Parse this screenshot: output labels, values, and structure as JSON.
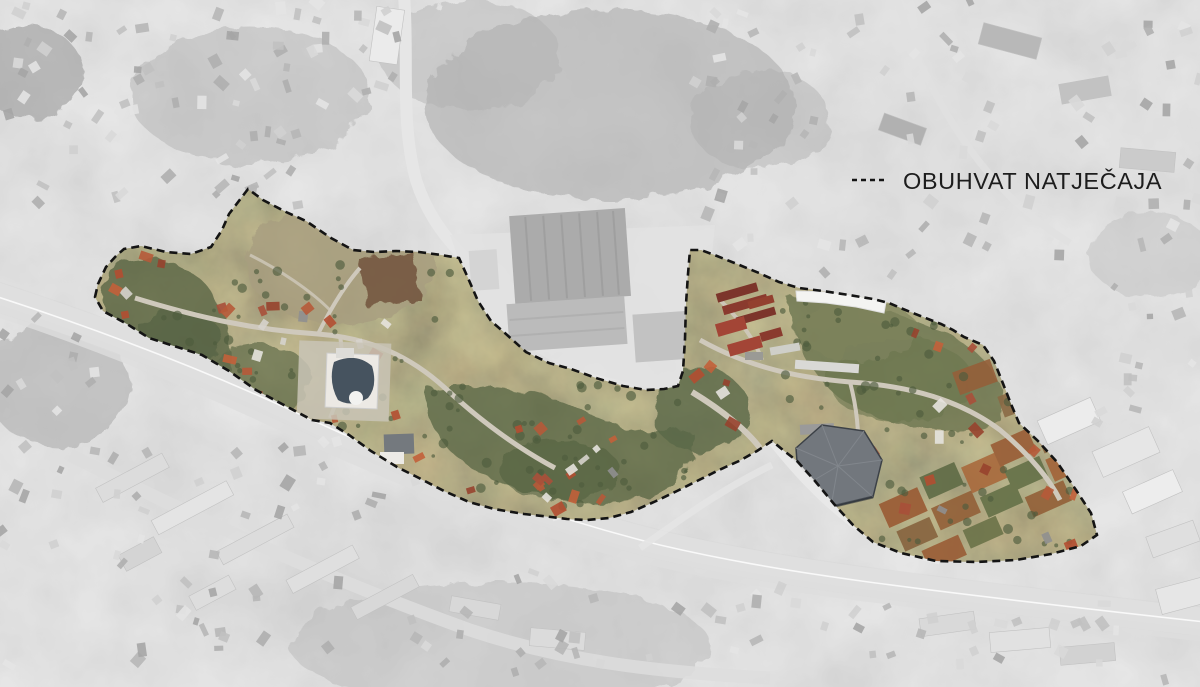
{
  "legend": {
    "label": "OBUHVAT NATJEČAJA",
    "symbol": "dashed-line"
  },
  "map": {
    "kind": "aerial-orthophoto site plan",
    "highlight_style": "competition area in color, surroundings desaturated and lightened",
    "boundary_style": "black dashed outline"
  },
  "colors": {
    "boundary": "#141414",
    "legend_text": "#1d1d1d",
    "background_gray": "#b3b3b3",
    "outside_wash": "#ffffff",
    "terrain_olive": "#968e71",
    "forest_green": "#57624a",
    "field_brown": "#74583f",
    "soil_orange": "#9a5c36",
    "roof_red": "#b24e31",
    "road_light": "#d9d9d9",
    "dome_roof_slate": "#46535f",
    "hall_roof_gray": "#72777d"
  }
}
